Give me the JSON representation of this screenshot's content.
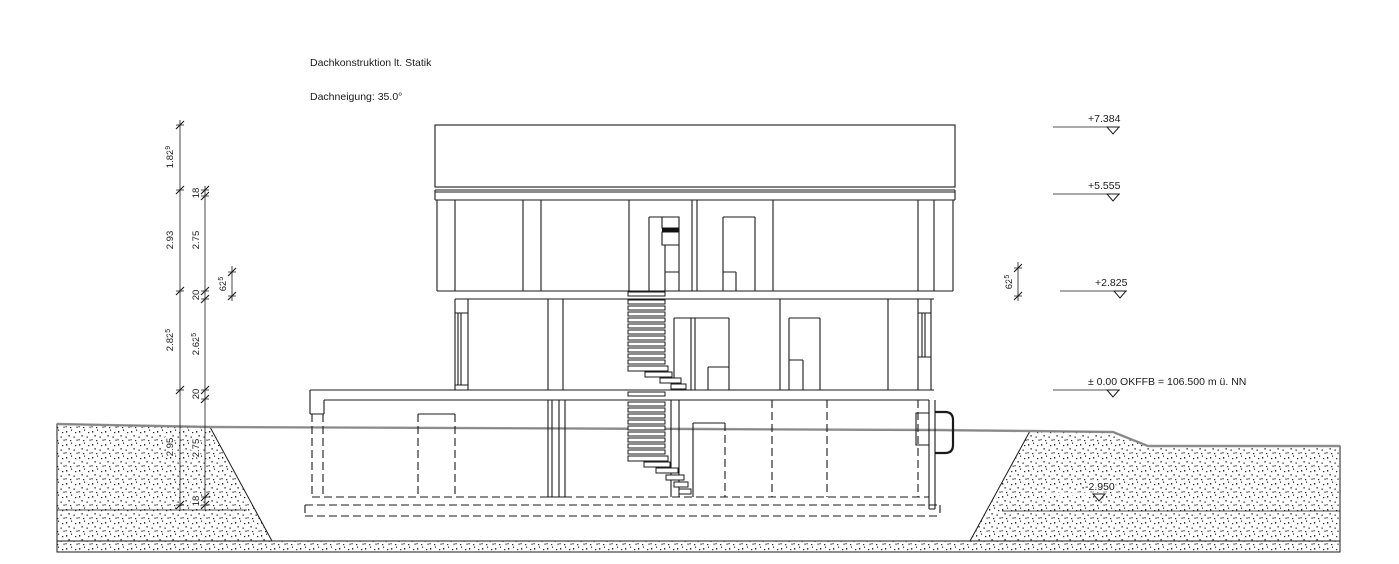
{
  "colors": {
    "line": "#1a1a1a",
    "terrain": "#8c8c8c",
    "paper": "#ffffff"
  },
  "notes": {
    "roof": "Dachkonstruktion lt. Statik",
    "pitch": "Dachneigung: 35.0°"
  },
  "levels": [
    {
      "label": "+7.384"
    },
    {
      "label": "+5.555"
    },
    {
      "label": "+2.825"
    },
    {
      "label": "± 0.00 OKFFB = 106.500 m ü. NN"
    },
    {
      "label": "-2.950"
    }
  ],
  "dims": {
    "outer": [
      {
        "v": "1.82",
        "sup": "9"
      },
      {
        "v": "2.93"
      },
      {
        "v": "2.82",
        "sup": "5"
      },
      {
        "v": "2.95"
      }
    ],
    "inner": [
      {
        "v": "18"
      },
      {
        "v": "2.75"
      },
      {
        "v": "20"
      },
      {
        "v": "2.62",
        "sup": "5"
      },
      {
        "v": "20"
      },
      {
        "v": "2.75"
      },
      {
        "v": "18"
      }
    ],
    "left_small": {
      "v": "62",
      "sup": "5"
    },
    "right_small": {
      "v": "62",
      "sup": "5"
    }
  }
}
